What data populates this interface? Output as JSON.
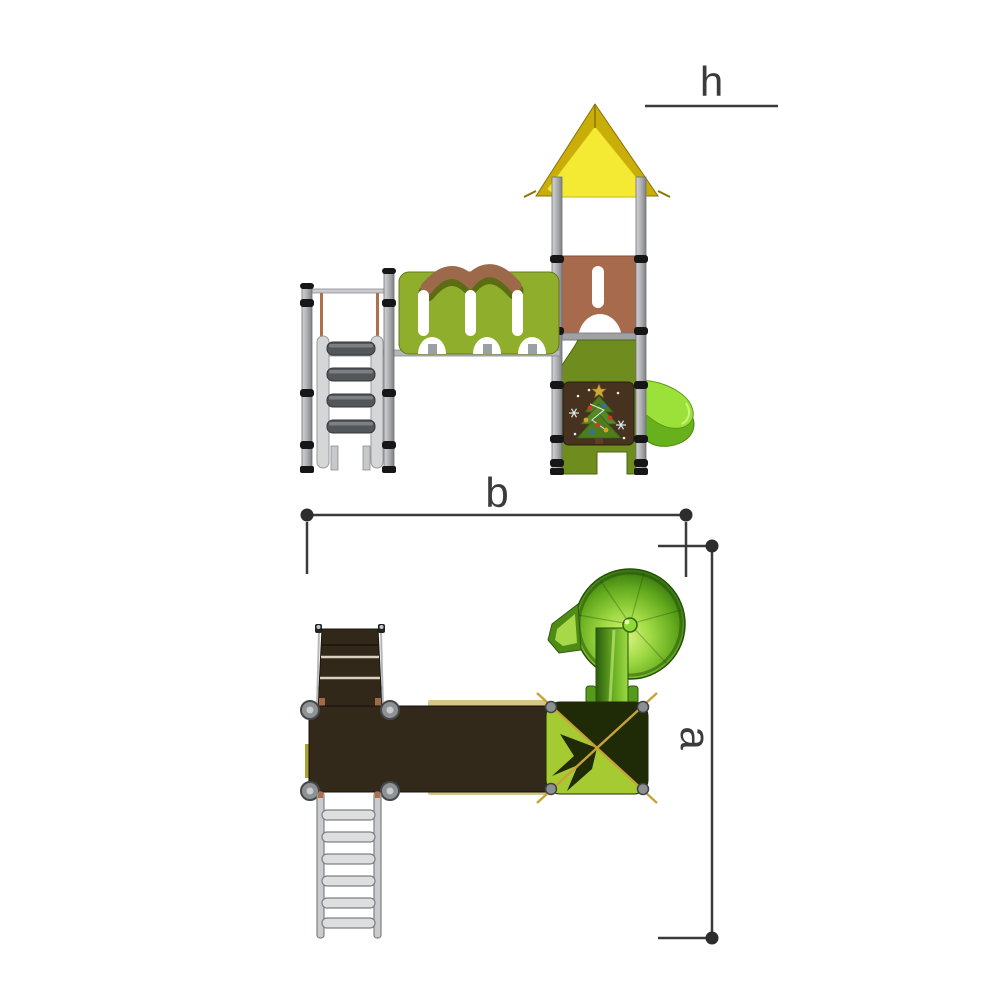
{
  "drawing": {
    "dimension_labels": {
      "height": "h",
      "width": "b",
      "depth": "a"
    },
    "parts": [
      "tower-roof",
      "tower-posts",
      "castle-fence-panel",
      "brown-door-panel",
      "christmas-tree-panel",
      "spiral-slide",
      "access-stairs",
      "metal-ladder",
      "walkway-deck",
      "roof-plan-square",
      "spiral-slide-disc"
    ],
    "colors": {
      "roof_yellow_bright": "#f4ea33",
      "roof_gold": "#c9ad08",
      "fence_green": "#8fae2b",
      "fence_cap_brown": "#9c6a4a",
      "door_panel_brown": "#a86a4c",
      "tower_body_olive": "#6f8d1e",
      "slide_green": "#9ce13a",
      "theme_panel_brown": "#46321f",
      "post_gray": "#aeb0b3",
      "plan_deck_dark": "#33291b",
      "plan_roof_bright": "#a6ca32",
      "plan_roof_dark": "#1f2a06",
      "gold_diagonal": "#c8a238",
      "dimension_line": "#3a3a3a",
      "background": "#ffffff"
    }
  }
}
